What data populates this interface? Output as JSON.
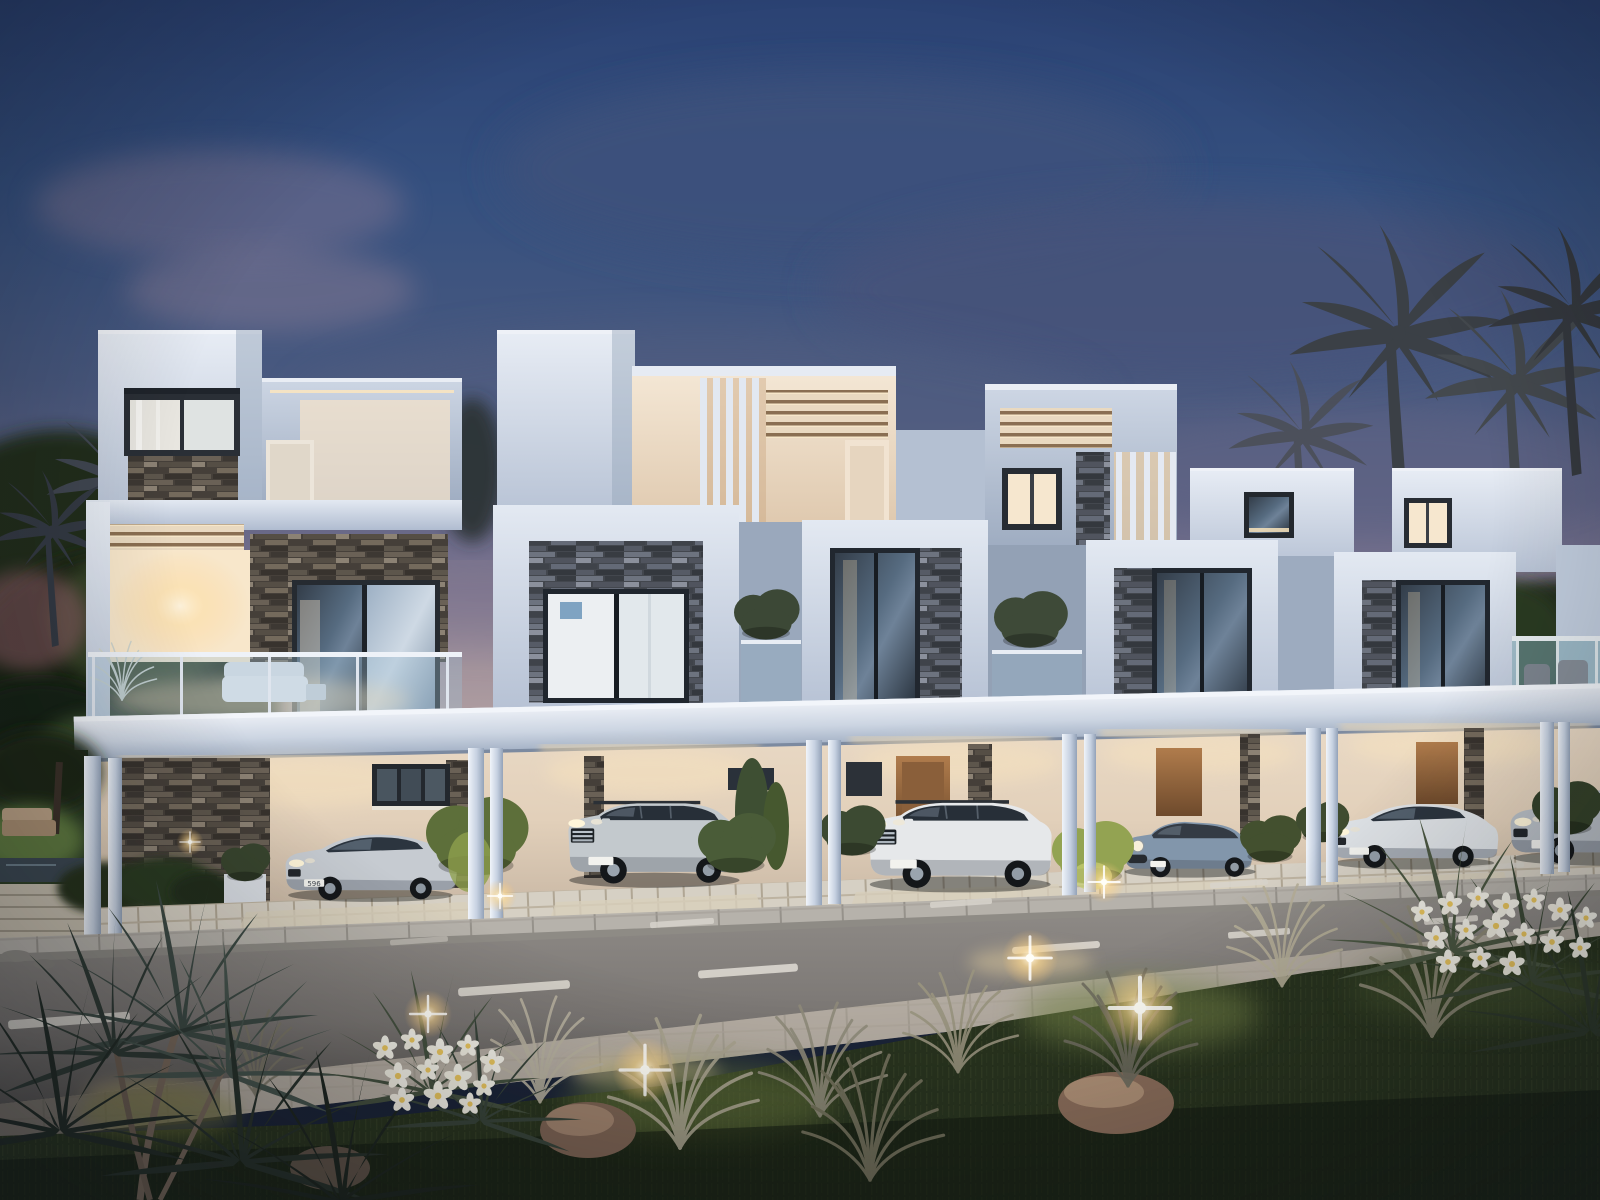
{
  "meta": {
    "title": "Modern townhouse row at dusk - architectural rendering"
  },
  "scene": {
    "description": "Photorealistic dusk rendering of a row of five modern white townhouses with stacked-stone accent walls, glass balcony balustrades, open carports with five parked cars, a street with dashed lane markings, landscaped foreground with plumeria shrubs, silver ornamental grasses, rocks and warm garden uplights, palm trees silhouetted against a deep blue evening sky",
    "time_of_day": "dusk",
    "villas_count": 5,
    "cars": [
      {
        "kind": "sedan",
        "model_hint": "BMW 6-series",
        "color_name": "silver",
        "body": "#c6cbd1",
        "plate": "596"
      },
      {
        "kind": "suv",
        "model_hint": "Mercedes ML",
        "color_name": "silver",
        "body": "#c3c9cd"
      },
      {
        "kind": "suv",
        "model_hint": "Range Rover",
        "color_name": "white",
        "body": "#e6e8ea"
      },
      {
        "kind": "hatchback",
        "model_hint": "Mini Cooper",
        "color_name": "steel blue",
        "body": "#8296ab"
      },
      {
        "kind": "sedan",
        "model_hint": "Audi",
        "color_name": "white",
        "body": "#dde1e5"
      },
      {
        "kind": "sedan",
        "model_hint": "partial car at right edge",
        "color_name": "silver",
        "body": "#b9bfc6"
      }
    ],
    "landscape": [
      "palm trees",
      "stacked stone accent walls",
      "glass balustrades",
      "plumeria shrubs with white flowers",
      "silver ornamental grasses",
      "lawn",
      "rocks",
      "garden uplights"
    ],
    "road": {
      "lane_dash_lines": 2,
      "sidewalks": true
    }
  },
  "palette": {
    "skyTop": "#2b4273",
    "skyMid": "#49597f",
    "skyHaze": "#7d7590",
    "skyHorizon": "#b7a6a6",
    "wallBright": "#e8edf5",
    "wallMid": "#c3cede",
    "wallShade": "#9dabc0",
    "warmWall": "#f6ead8",
    "warmGlow": "#ffdfae",
    "stoneDark": "#4f4840",
    "stoneBlue": "#4a4e55",
    "glassDark": "#323c48",
    "glassLit": "#f6e7cf",
    "road": "#8e8a86",
    "sidewalk": "#b6b2ab",
    "driveway": "#d6d0c4",
    "grassDark": "#2e3823",
    "grassLit": "#6a7a3c",
    "leafDark": "#3d4a44",
    "leafSilver": "#b8b2a0",
    "flowerPetal": "#f3f1e8",
    "flowerCenter": "#e9c55e",
    "rock": "#8d6f5c"
  }
}
